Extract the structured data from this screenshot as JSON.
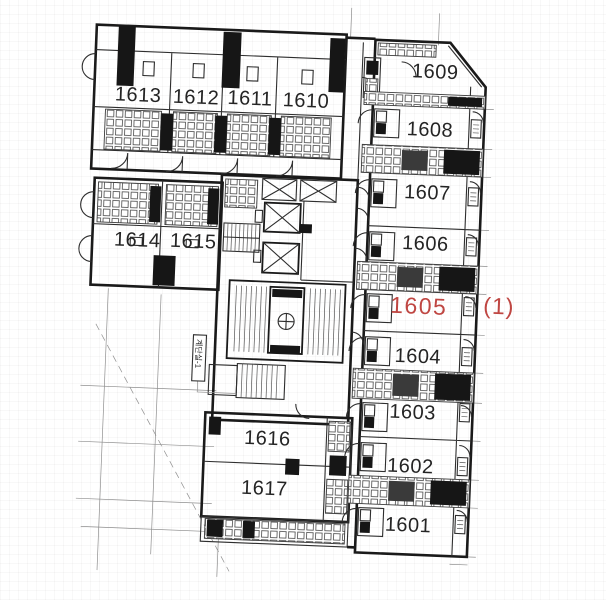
{
  "colors": {
    "wall": "#1a1a1a",
    "detail": "#2e2e2e",
    "thin_grid": "#8f8f8f",
    "highlight": "#bf4642",
    "label": "#242424",
    "background": "#ffffff"
  },
  "plan": {
    "rooms": [
      {
        "label": "1613",
        "highlighted": false
      },
      {
        "label": "1612",
        "highlighted": false
      },
      {
        "label": "1611",
        "highlighted": false
      },
      {
        "label": "1610",
        "highlighted": false
      },
      {
        "label": "1614",
        "highlighted": false
      },
      {
        "label": "1615",
        "highlighted": false
      },
      {
        "label": "1609",
        "highlighted": false
      },
      {
        "label": "1608",
        "highlighted": false
      },
      {
        "label": "1607",
        "highlighted": false
      },
      {
        "label": "1606",
        "highlighted": false
      },
      {
        "label": "1605",
        "highlighted": true
      },
      {
        "label": "1604",
        "highlighted": false
      },
      {
        "label": "1603",
        "highlighted": false
      },
      {
        "label": "1602",
        "highlighted": false
      },
      {
        "label": "1601",
        "highlighted": false
      },
      {
        "label": "1616",
        "highlighted": false
      },
      {
        "label": "1617",
        "highlighted": false
      }
    ],
    "annotation": {
      "label": "(1)"
    },
    "stair_label": {
      "label": "계단실-1"
    }
  }
}
